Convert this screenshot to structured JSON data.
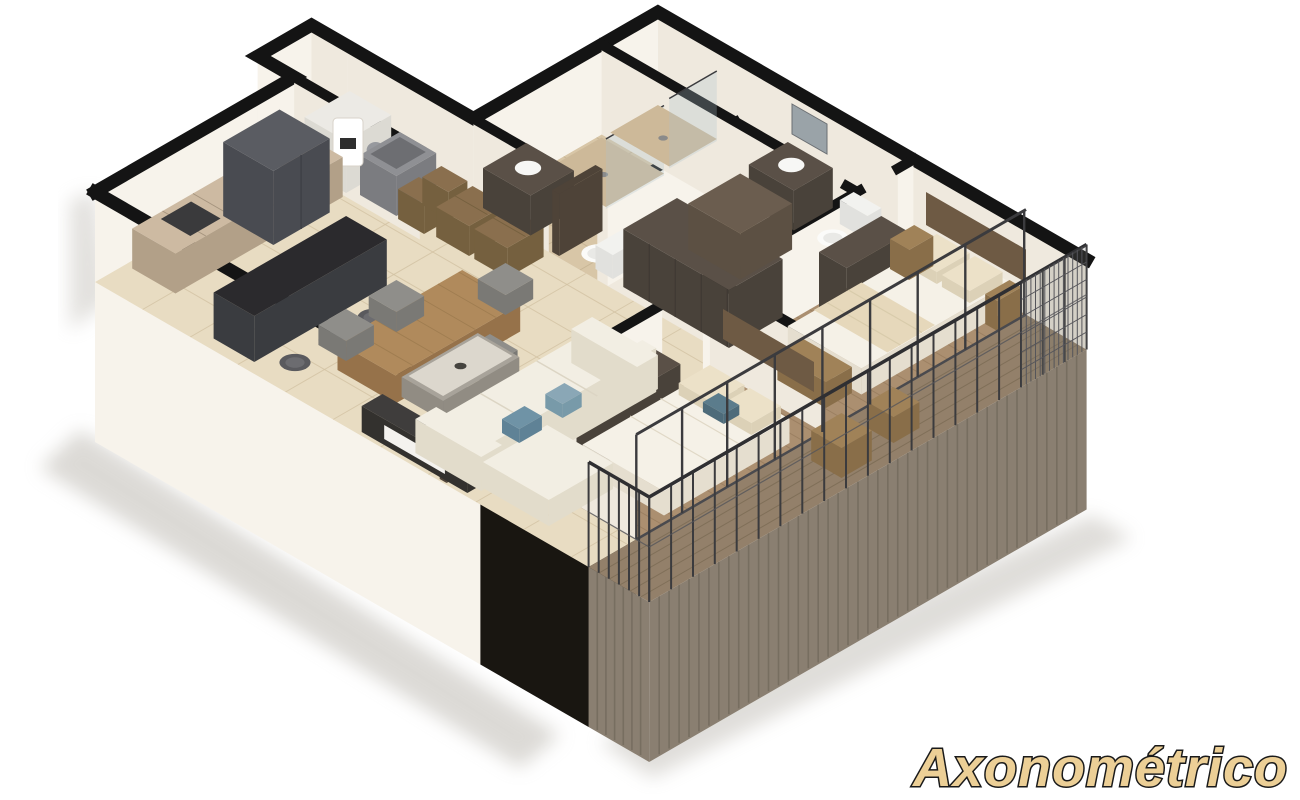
{
  "caption": {
    "text": "Axonométrico"
  },
  "palette": {
    "wall_cap": "#141414",
    "wall_face": "#f7f3eb",
    "wall_face_side": "#efe9de",
    "ext_black": "#191611",
    "tile": "#e8dcc2",
    "tile_line": "#d2c2a3",
    "bath_tile": "#d8c6a7",
    "bath_line": "#c4b191",
    "wood": "#ab8f70",
    "wood_line": "#987d5f",
    "deck": "#93806a",
    "deck_line": "#7e6d57",
    "fascia": "#8a7f71",
    "fascia_line": "#736a5c",
    "cabinet_top": "#cdbaa2",
    "cabinet_side": "#b2a088",
    "counter_top": "#2b2a2d",
    "counter_side": "#3a3c40",
    "fridge": "#5a5c62",
    "fridge_dark": "#494b51",
    "sofa": "#f2eee3",
    "sofa_side": "#e2dccb",
    "bed": "#f5f1e7",
    "bed_side": "#e5decf",
    "pillow": "#ece1c8",
    "throw": "#e6d8bb",
    "wood_furn": "#a08258",
    "wood_furn_side": "#896e49",
    "dark_furn": "#5a5047",
    "dark_furn_side": "#49423a",
    "gray_chair": "#8f8e8a",
    "gray_chair_side": "#7a7975",
    "marble": "#dcd7cd",
    "metal": "#3b3b3e",
    "glass_tint": "#aec3cc",
    "accent_blue": "#6f93a6",
    "mirror": "#9aa3a8",
    "wicker": "#8a6f4e",
    "wicker_side": "#75603f",
    "shaft": "#7a8087",
    "door_dark": "#4e4338",
    "shadow": "#b9b5ad",
    "gold": "#eccf96",
    "gold_stroke": "#1a1a1a",
    "white": "#ffffff"
  },
  "scene": {
    "type": "axonometric-floorplan-render",
    "rooms": [
      "kitchen",
      "laundry",
      "bathroom-1",
      "bathroom-2",
      "closet",
      "hallway",
      "master-bedroom",
      "bedroom-2",
      "dining-area",
      "living-room",
      "balcony"
    ]
  }
}
